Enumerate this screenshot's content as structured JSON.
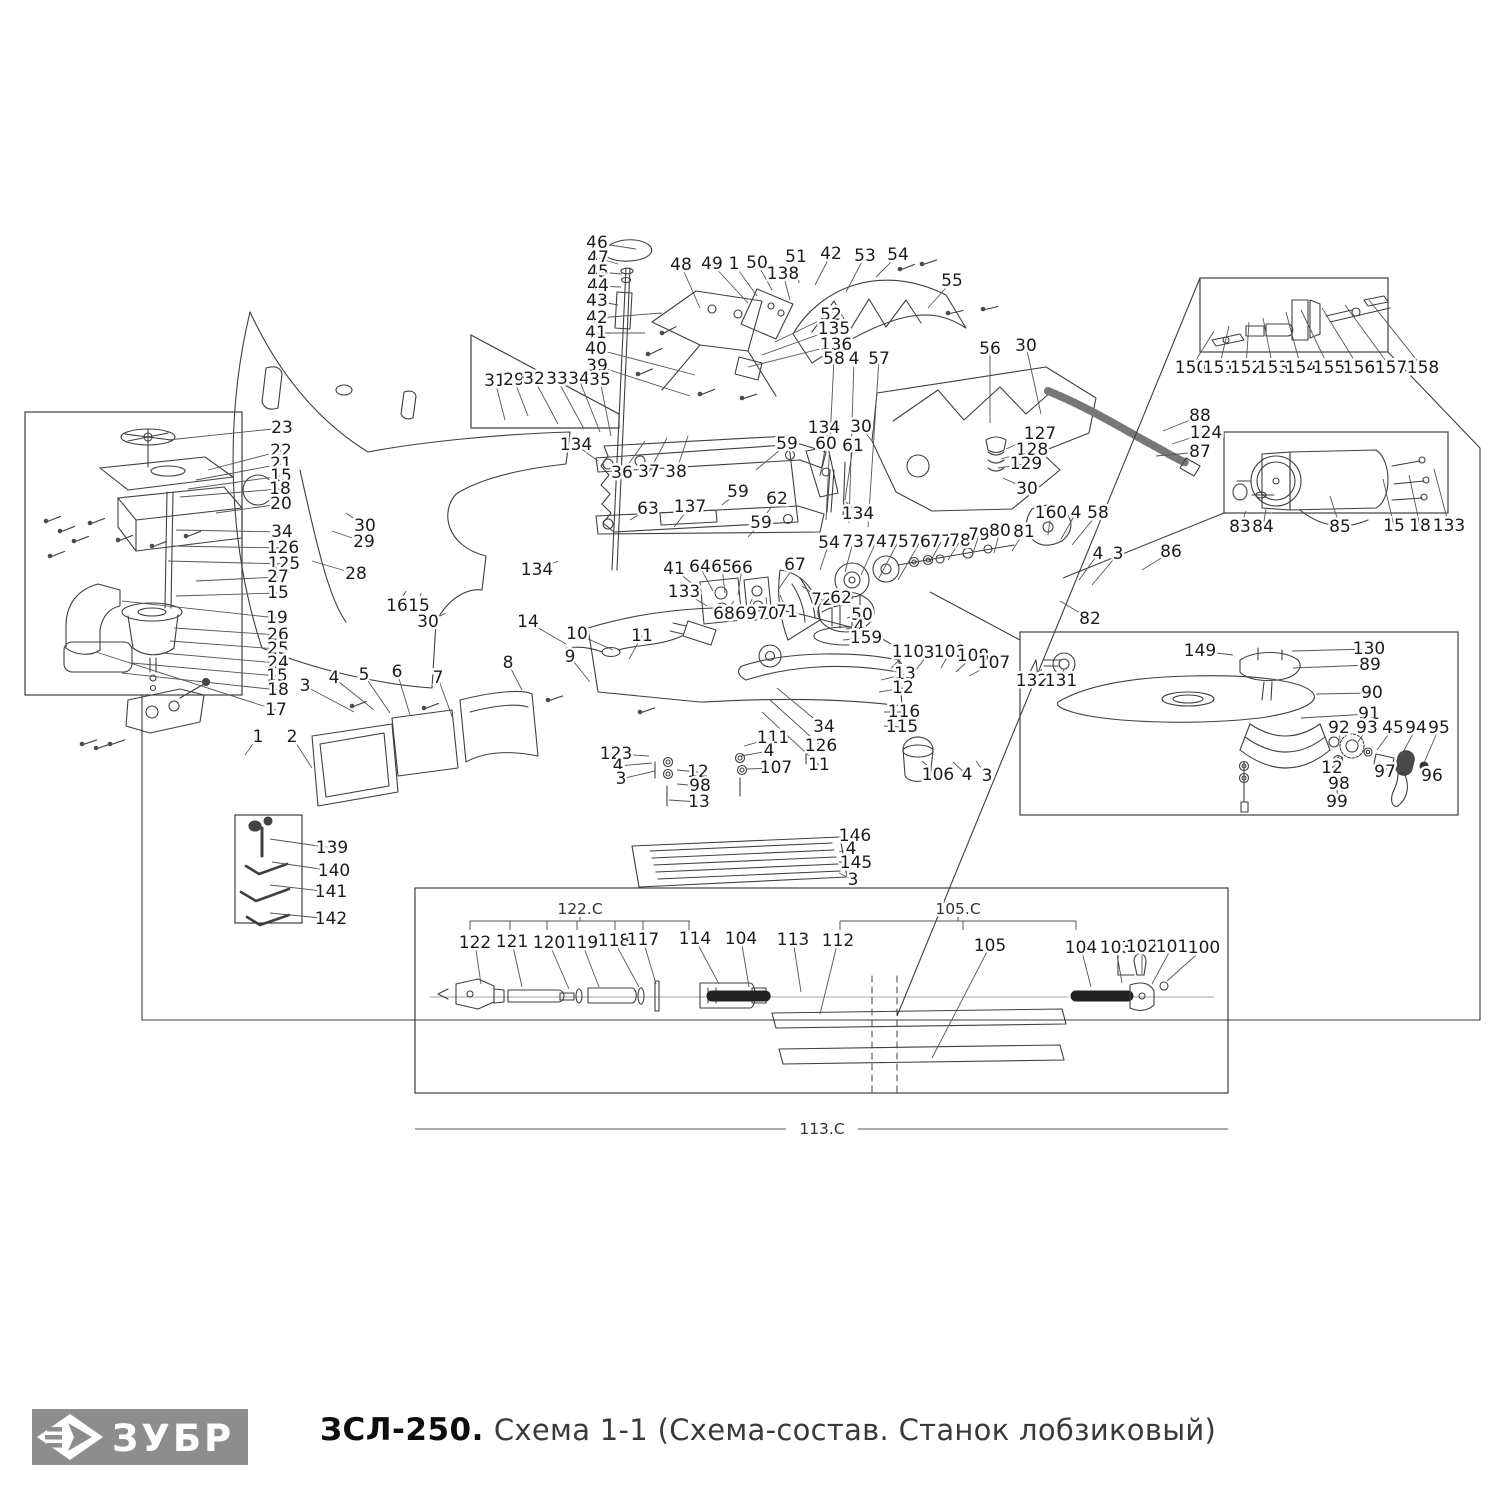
{
  "footer": {
    "logo_text": "ЗУБР",
    "model": "ЗСЛ-250.",
    "title": "Схема 1-1 (Схема-состав. Станок лобзиковый)"
  },
  "colors": {
    "line": "#3f3f3f",
    "leader": "#555555",
    "label": "#1c1c1c",
    "logo_bg": "#8d8d8d"
  },
  "diagram": {
    "labels": [
      [
        "46",
        597,
        243,
        636,
        249
      ],
      [
        "47",
        598,
        258,
        618,
        264
      ],
      [
        "45",
        598,
        272,
        622,
        274
      ],
      [
        "44",
        598,
        286,
        621,
        287
      ],
      [
        "43",
        597,
        301,
        618,
        305
      ],
      [
        "42",
        597,
        318,
        662,
        313
      ],
      [
        "41",
        596,
        333,
        645,
        333
      ],
      [
        "40",
        596,
        349,
        695,
        375
      ],
      [
        "39",
        597,
        366,
        690,
        396
      ],
      [
        "48",
        681,
        265,
        700,
        308
      ],
      [
        "49",
        712,
        264,
        748,
        303
      ],
      [
        "1",
        734,
        264,
        757,
        296
      ],
      [
        "50",
        757,
        263,
        772,
        290
      ],
      [
        "138",
        783,
        274,
        790,
        300
      ],
      [
        "51",
        796,
        257,
        799,
        283
      ],
      [
        "42",
        831,
        254,
        815,
        285
      ],
      [
        "53",
        865,
        256,
        846,
        292
      ],
      [
        "54",
        898,
        255,
        876,
        277
      ],
      [
        "55",
        952,
        281,
        928,
        308
      ],
      [
        "52",
        831,
        315,
        775,
        342
      ],
      [
        "135",
        834,
        329,
        762,
        355
      ],
      [
        "136",
        836,
        345,
        748,
        367
      ],
      [
        "58",
        834,
        359,
        826,
        520
      ],
      [
        "4",
        854,
        359,
        849,
        523
      ],
      [
        "57",
        879,
        359,
        868,
        527
      ],
      [
        "56",
        990,
        349,
        990,
        423
      ],
      [
        "30",
        1026,
        346,
        1041,
        414
      ],
      [
        "31",
        495,
        381,
        505,
        420
      ],
      [
        "29",
        514,
        380,
        528,
        416
      ],
      [
        "32",
        534,
        379,
        558,
        424
      ],
      [
        "33",
        557,
        379,
        584,
        429
      ],
      [
        "34",
        579,
        379,
        600,
        432
      ],
      [
        "35",
        600,
        380,
        611,
        436
      ],
      [
        "134",
        576,
        445,
        598,
        461
      ],
      [
        "36",
        622,
        473,
        645,
        441
      ],
      [
        "37",
        649,
        472,
        667,
        438
      ],
      [
        "38",
        676,
        472,
        688,
        436
      ],
      [
        "59",
        787,
        444,
        756,
        470
      ],
      [
        "60",
        826,
        444,
        820,
        476
      ],
      [
        "61",
        853,
        446,
        845,
        500
      ],
      [
        "134",
        824,
        428,
        833,
        449
      ],
      [
        "30",
        861,
        427,
        872,
        441
      ],
      [
        "59",
        738,
        492,
        722,
        505
      ],
      [
        "62",
        777,
        499,
        762,
        520
      ],
      [
        "59",
        761,
        523,
        748,
        537
      ],
      [
        "134",
        858,
        514,
        846,
        502
      ],
      [
        "63",
        648,
        509,
        630,
        520
      ],
      [
        "137",
        690,
        507,
        674,
        527
      ],
      [
        "127",
        1040,
        434,
        1006,
        449
      ],
      [
        "128",
        1032,
        450,
        1001,
        459
      ],
      [
        "129",
        1026,
        464,
        998,
        468
      ],
      [
        "30",
        1027,
        489,
        1003,
        478
      ],
      [
        "88",
        1200,
        416,
        1163,
        431
      ],
      [
        "124",
        1206,
        433,
        1172,
        444
      ],
      [
        "87",
        1200,
        452,
        1156,
        456
      ],
      [
        "23",
        282,
        428,
        168,
        440
      ],
      [
        "22",
        281,
        451,
        208,
        470
      ],
      [
        "21",
        281,
        464,
        196,
        480
      ],
      [
        "15",
        281,
        476,
        188,
        489
      ],
      [
        "18",
        280,
        489,
        180,
        497
      ],
      [
        "20",
        281,
        504,
        216,
        513
      ],
      [
        "34",
        282,
        532,
        176,
        530
      ],
      [
        "126",
        283,
        548,
        172,
        546
      ],
      [
        "125",
        284,
        564,
        168,
        561
      ],
      [
        "27",
        278,
        577,
        196,
        581
      ],
      [
        "15",
        278,
        593,
        176,
        596
      ],
      [
        "19",
        277,
        618,
        122,
        601
      ],
      [
        "26",
        278,
        635,
        174,
        628
      ],
      [
        "25",
        278,
        649,
        170,
        641
      ],
      [
        "24",
        278,
        663,
        162,
        653
      ],
      [
        "15",
        277,
        676,
        132,
        663
      ],
      [
        "18",
        278,
        690,
        122,
        673
      ],
      [
        "17",
        276,
        710,
        96,
        652
      ],
      [
        "30",
        365,
        526,
        346,
        513
      ],
      [
        "29",
        364,
        542,
        332,
        531
      ],
      [
        "28",
        356,
        574,
        312,
        561
      ],
      [
        "16",
        397,
        606,
        406,
        591
      ],
      [
        "15",
        419,
        606,
        421,
        593
      ],
      [
        "30",
        428,
        622,
        446,
        613
      ],
      [
        "134",
        537,
        570,
        558,
        561
      ],
      [
        "54",
        829,
        543,
        820,
        570
      ],
      [
        "73",
        853,
        542,
        845,
        572
      ],
      [
        "74",
        876,
        542,
        861,
        575
      ],
      [
        "75",
        898,
        542,
        879,
        578
      ],
      [
        "76",
        920,
        542,
        898,
        580
      ],
      [
        "77",
        941,
        542,
        930,
        562
      ],
      [
        "78",
        960,
        541,
        948,
        560
      ],
      [
        "79",
        979,
        535,
        972,
        556
      ],
      [
        "80",
        1000,
        531,
        994,
        553
      ],
      [
        "81",
        1024,
        532,
        1012,
        551
      ],
      [
        "160",
        1051,
        513,
        1048,
        535
      ],
      [
        "4",
        1076,
        513,
        1061,
        539
      ],
      [
        "58",
        1098,
        513,
        1072,
        545
      ],
      [
        "41",
        674,
        569,
        700,
        590
      ],
      [
        "64",
        700,
        567,
        713,
        591
      ],
      [
        "65",
        722,
        567,
        725,
        593
      ],
      [
        "66",
        742,
        568,
        738,
        595
      ],
      [
        "67",
        795,
        565,
        778,
        590
      ],
      [
        "133",
        684,
        592,
        707,
        606
      ],
      [
        "68",
        724,
        614,
        734,
        601
      ],
      [
        "69",
        746,
        614,
        752,
        599
      ],
      [
        "70",
        768,
        614,
        766,
        597
      ],
      [
        "71",
        787,
        612,
        780,
        595
      ],
      [
        "72",
        822,
        600,
        802,
        586
      ],
      [
        "62",
        841,
        598,
        820,
        591
      ],
      [
        "50",
        862,
        615,
        847,
        618
      ],
      [
        "4",
        859,
        627,
        846,
        629
      ],
      [
        "159",
        866,
        638,
        843,
        640
      ],
      [
        "110",
        908,
        652,
        891,
        668
      ],
      [
        "3",
        929,
        653,
        916,
        670
      ],
      [
        "109",
        950,
        652,
        941,
        668
      ],
      [
        "108",
        973,
        656,
        956,
        672
      ],
      [
        "107",
        994,
        663,
        969,
        676
      ],
      [
        "13",
        905,
        674,
        881,
        680
      ],
      [
        "12",
        903,
        688,
        879,
        692
      ],
      [
        "116",
        904,
        712,
        884,
        712
      ],
      [
        "115",
        902,
        727,
        884,
        726
      ],
      [
        "34",
        824,
        727,
        777,
        688
      ],
      [
        "126",
        821,
        746,
        770,
        700
      ],
      [
        "11",
        819,
        765,
        762,
        712
      ],
      [
        "11",
        642,
        636,
        629,
        659
      ],
      [
        "4",
        1098,
        554,
        1079,
        580
      ],
      [
        "3",
        1118,
        554,
        1092,
        585
      ],
      [
        "86",
        1171,
        552,
        1142,
        570
      ],
      [
        "82",
        1090,
        619,
        1060,
        601
      ],
      [
        "83",
        1240,
        527,
        1246,
        511
      ],
      [
        "84",
        1263,
        527,
        1266,
        509
      ],
      [
        "85",
        1340,
        527,
        1330,
        496
      ],
      [
        "15",
        1394,
        526,
        1383,
        479
      ],
      [
        "18",
        1420,
        526,
        1409,
        475
      ],
      [
        "133",
        1449,
        526,
        1434,
        469
      ],
      [
        "150",
        1191,
        368,
        1214,
        331
      ],
      [
        "151",
        1219,
        368,
        1229,
        326
      ],
      [
        "152",
        1246,
        368,
        1249,
        322
      ],
      [
        "153",
        1273,
        368,
        1263,
        318
      ],
      [
        "154",
        1301,
        368,
        1286,
        312
      ],
      [
        "155",
        1329,
        368,
        1301,
        310
      ],
      [
        "156",
        1359,
        368,
        1322,
        308
      ],
      [
        "157",
        1391,
        368,
        1345,
        305
      ],
      [
        "158",
        1423,
        368,
        1369,
        300
      ],
      [
        "149",
        1200,
        651,
        1233,
        655
      ],
      [
        "130",
        1369,
        649,
        1292,
        651
      ],
      [
        "89",
        1370,
        665,
        1293,
        668
      ],
      [
        "90",
        1372,
        693,
        1316,
        694
      ],
      [
        "91",
        1369,
        714,
        1301,
        718
      ],
      [
        "92",
        1339,
        728,
        1340,
        740
      ],
      [
        "93",
        1367,
        728,
        1358,
        742
      ],
      [
        "45",
        1393,
        728,
        1377,
        750
      ],
      [
        "94",
        1416,
        728,
        1401,
        756
      ],
      [
        "95",
        1439,
        728,
        1424,
        763
      ],
      [
        "97",
        1385,
        772,
        1390,
        762
      ],
      [
        "96",
        1432,
        776,
        1434,
        768
      ],
      [
        "12",
        1332,
        768,
        1343,
        757
      ],
      [
        "98",
        1339,
        784,
        1343,
        772
      ],
      [
        "99",
        1337,
        802,
        1343,
        790
      ],
      [
        "132",
        1032,
        681,
        1042,
        669
      ],
      [
        "131",
        1061,
        681,
        1064,
        669
      ],
      [
        "1",
        258,
        737,
        245,
        755
      ],
      [
        "2",
        292,
        737,
        312,
        768
      ],
      [
        "3",
        305,
        686,
        354,
        712
      ],
      [
        "4",
        334,
        678,
        374,
        710
      ],
      [
        "5",
        364,
        675,
        390,
        713
      ],
      [
        "6",
        397,
        672,
        410,
        715
      ],
      [
        "7",
        438,
        678,
        453,
        719
      ],
      [
        "8",
        508,
        663,
        522,
        690
      ],
      [
        "9",
        570,
        657,
        590,
        682
      ],
      [
        "10",
        577,
        634,
        613,
        650
      ],
      [
        "14",
        528,
        622,
        566,
        644
      ],
      [
        "123",
        616,
        754,
        649,
        756
      ],
      [
        "4",
        618,
        766,
        652,
        763
      ],
      [
        "3",
        621,
        779,
        655,
        771
      ],
      [
        "12",
        698,
        772,
        677,
        770
      ],
      [
        "98",
        700,
        786,
        677,
        784
      ],
      [
        "13",
        699,
        802,
        669,
        800
      ],
      [
        "111",
        773,
        738,
        744,
        746
      ],
      [
        "4",
        769,
        751,
        741,
        756
      ],
      [
        "107",
        776,
        768,
        746,
        769
      ],
      [
        "106",
        938,
        775,
        922,
        761
      ],
      [
        "4",
        967,
        775,
        953,
        762
      ],
      [
        "3",
        987,
        776,
        976,
        761
      ],
      [
        "146",
        855,
        836,
        839,
        843
      ],
      [
        "4",
        851,
        849,
        839,
        852
      ],
      [
        "145",
        856,
        863,
        839,
        862
      ],
      [
        "3",
        853,
        880,
        839,
        873
      ],
      [
        "139",
        332,
        848,
        270,
        839
      ],
      [
        "140",
        334,
        871,
        272,
        862
      ],
      [
        "141",
        331,
        892,
        270,
        885
      ],
      [
        "142",
        331,
        919,
        270,
        913
      ],
      [
        "122",
        475,
        943,
        481,
        984
      ],
      [
        "121",
        512,
        942,
        522,
        987
      ],
      [
        "120",
        549,
        943,
        569,
        989
      ],
      [
        "119",
        582,
        943,
        599,
        987
      ],
      [
        "118",
        614,
        941,
        639,
        987
      ],
      [
        "117",
        643,
        940,
        656,
        984
      ],
      [
        "114",
        695,
        939,
        719,
        984
      ],
      [
        "104",
        741,
        939,
        749,
        987
      ],
      [
        "113",
        793,
        940,
        801,
        992
      ],
      [
        "112",
        838,
        941,
        820,
        1014
      ],
      [
        "105",
        990,
        946,
        932,
        1058
      ],
      [
        "104",
        1081,
        948,
        1091,
        987
      ],
      [
        "103",
        1116,
        948,
        1122,
        983
      ],
      [
        "102",
        1142,
        947,
        1142,
        974
      ],
      [
        "101",
        1172,
        947,
        1152,
        984
      ],
      [
        "100",
        1204,
        948,
        1167,
        981
      ]
    ],
    "boxes": [
      [
        25,
        412,
        217,
        283
      ],
      [
        235,
        815,
        67,
        108
      ],
      [
        1200,
        278,
        188,
        74
      ],
      [
        1224,
        432,
        224,
        81
      ],
      [
        1020,
        632,
        438,
        183
      ],
      [
        415,
        888,
        813,
        205
      ]
    ],
    "polygons": [
      "471,335 619,414 619,428 471,428"
    ],
    "connectors": [
      [
        [
          142,
          695
        ],
        [
          142,
          1020
        ],
        [
          1480,
          1020
        ],
        [
          1480,
          448
        ]
      ],
      [
        [
          1480,
          448
        ],
        [
          1388,
          352
        ]
      ],
      [
        [
          1200,
          278
        ],
        [
          897,
          1016
        ]
      ],
      [
        [
          1224,
          513
        ],
        [
          1063,
          578
        ]
      ],
      [
        [
          1020,
          640
        ],
        [
          930,
          592
        ]
      ]
    ],
    "brackets": [
      {
        "t": "122.C",
        "label_x": 580,
        "label_y": 909,
        "y": 921,
        "x1": 470,
        "x2": 690,
        "ticks": [
          470,
          510,
          547,
          577,
          615,
          643,
          689
        ]
      },
      {
        "t": "105.C",
        "label_x": 958,
        "label_y": 909,
        "y": 921,
        "x1": 840,
        "x2": 1076,
        "ticks": [
          840,
          963,
          1076
        ]
      }
    ],
    "section_line": {
      "t": "113.C",
      "y": 1129,
      "x1": 415,
      "x2": 1228,
      "gap1": 786,
      "gap2": 858
    }
  }
}
